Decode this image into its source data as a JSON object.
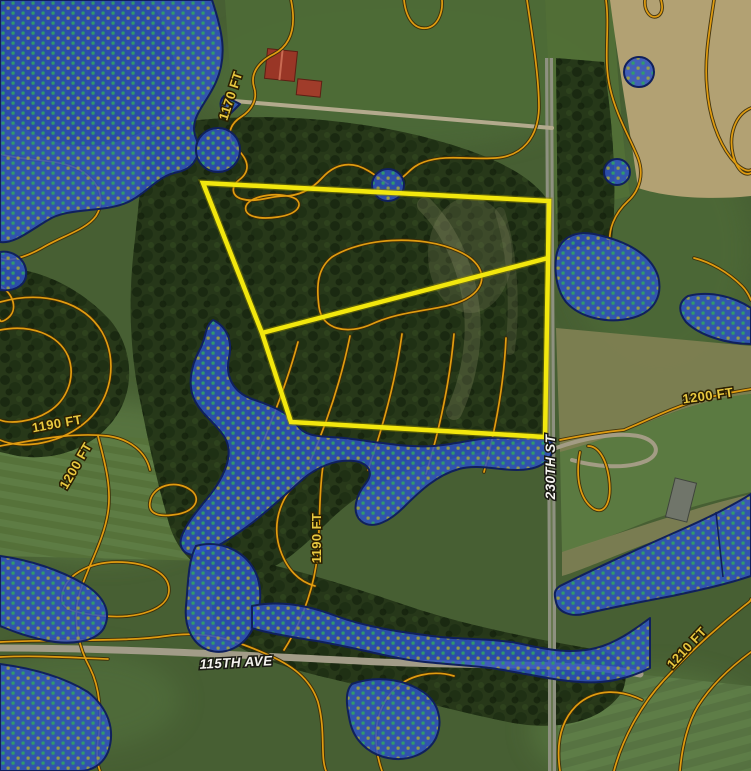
{
  "map": {
    "title": "Aerial parcel map with wetland overlay and elevation contours",
    "contour_labels": [
      {
        "text": "1170 FT"
      },
      {
        "text": "1190 FT"
      },
      {
        "text": "1200 FT"
      },
      {
        "text": "1190 FT"
      },
      {
        "text": "1200 FT"
      },
      {
        "text": "1210 FT"
      }
    ],
    "road_labels": [
      {
        "text": "230TH ST"
      },
      {
        "text": "115TH AVE"
      }
    ],
    "colors": {
      "contour_line": "#e09c10",
      "contour_label": "#e9c83f",
      "parcel_boundary": "#f2e70e",
      "wetland_fill": "#2d52c4",
      "wetland_border": "#10205c",
      "wetland_dot_green": "#2f9e68",
      "wetland_dot_olive": "#9fa23f",
      "road_label": "#f4f3ee"
    },
    "parcel": {
      "outer_points": "203,183 549,201 545,437 291,422 262,333",
      "divider_from": "262,333",
      "divider_to": "548,258"
    }
  }
}
